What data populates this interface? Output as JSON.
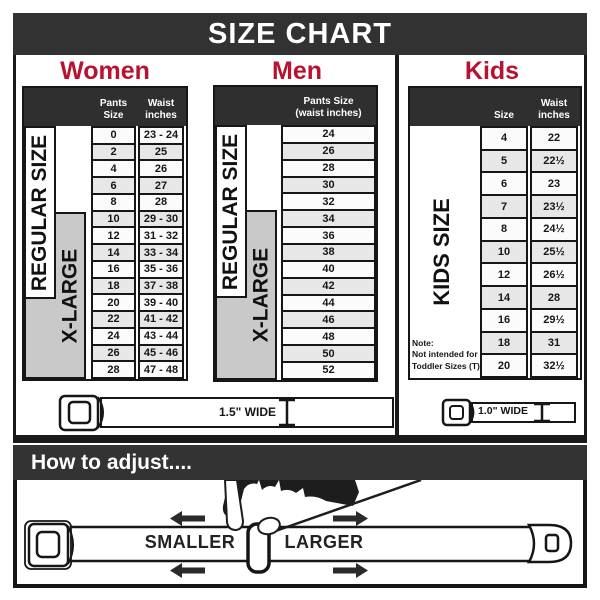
{
  "page_title": "SIZE CHART",
  "sections": {
    "women": "Women",
    "men": "Men",
    "kids": "Kids"
  },
  "women_table": {
    "col_pants": "Pants Size",
    "col_waist_l1": "Waist",
    "col_waist_l2": "inches",
    "regular_label": "REGULAR SIZE",
    "xlarge_label": "X-LARGE",
    "rows": [
      {
        "size": "0",
        "waist": "23 - 24"
      },
      {
        "size": "2",
        "waist": "25"
      },
      {
        "size": "4",
        "waist": "26"
      },
      {
        "size": "6",
        "waist": "27"
      },
      {
        "size": "8",
        "waist": "28"
      },
      {
        "size": "10",
        "waist": "29 - 30"
      },
      {
        "size": "12",
        "waist": "31 - 32"
      },
      {
        "size": "14",
        "waist": "33 - 34"
      },
      {
        "size": "16",
        "waist": "35 - 36"
      },
      {
        "size": "18",
        "waist": "37 - 38"
      },
      {
        "size": "20",
        "waist": "39 - 40"
      },
      {
        "size": "22",
        "waist": "41 - 42"
      },
      {
        "size": "24",
        "waist": "43 - 44"
      },
      {
        "size": "26",
        "waist": "45 - 46"
      },
      {
        "size": "28",
        "waist": "47 - 48"
      }
    ]
  },
  "men_table": {
    "col_l1": "Pants Size",
    "col_l2": "(waist inches)",
    "regular_label": "REGULAR SIZE",
    "xlarge_label": "X-LARGE",
    "rows": [
      "24",
      "26",
      "28",
      "30",
      "32",
      "34",
      "36",
      "38",
      "40",
      "42",
      "44",
      "46",
      "48",
      "50",
      "52"
    ]
  },
  "kids_table": {
    "col_size": "Size",
    "col_waist_l1": "Waist",
    "col_waist_l2": "inches",
    "label": "KIDS SIZE",
    "note_l1": "Note:",
    "note_l2": "Not intended for",
    "note_l3": "Toddler Sizes (T)",
    "rows": [
      {
        "size": "4",
        "waist": "22"
      },
      {
        "size": "5",
        "waist": "22½"
      },
      {
        "size": "6",
        "waist": "23"
      },
      {
        "size": "7",
        "waist": "23½"
      },
      {
        "size": "8",
        "waist": "24½"
      },
      {
        "size": "10",
        "waist": "25½"
      },
      {
        "size": "12",
        "waist": "26½"
      },
      {
        "size": "14",
        "waist": "28"
      },
      {
        "size": "16",
        "waist": "29½"
      },
      {
        "size": "18",
        "waist": "31"
      },
      {
        "size": "20",
        "waist": "32½"
      }
    ]
  },
  "belts": {
    "adult_label": "1.5\" WIDE",
    "kids_label": "1.0\" WIDE"
  },
  "adjust": {
    "header": "How to adjust....",
    "smaller": "SMALLER",
    "larger": "LARGER"
  },
  "colors": {
    "bar": "#323232",
    "table_header": "#2f2f2f",
    "accent_red": "#b81230",
    "gray_box": "#c9c9c9",
    "row_alt": "#e7e7e7",
    "line": "#161616"
  }
}
